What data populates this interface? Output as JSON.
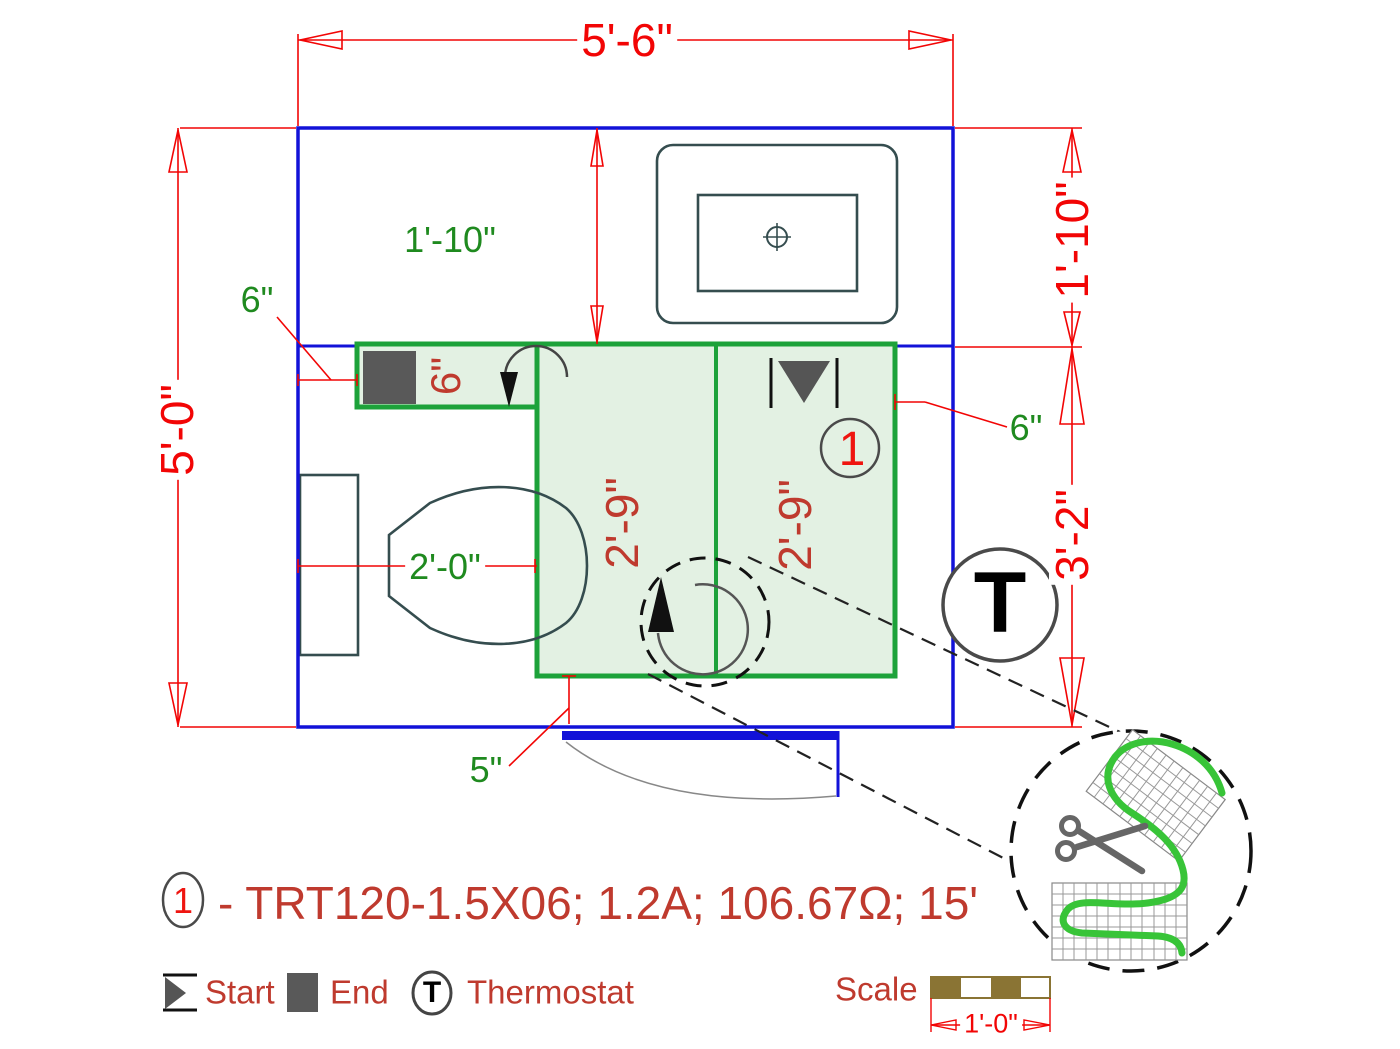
{
  "colors": {
    "wall_blue": "#1212d8",
    "dimension_red": "#f20505",
    "label_red": "#bf3a2e",
    "label_green": "#1f8a1f",
    "mat_border_green": "#1da23a",
    "mat_fill_green": "#e3f1e3",
    "fixture_slate": "#354d4f",
    "symbol_gray": "#555555",
    "wire_green": "#38c438",
    "scale_brown": "#8a7434"
  },
  "dimensions": {
    "room_width_top": "5'-6\"",
    "room_height_left": "5'-0\"",
    "nook_depth_right": "1'-10\"",
    "mat_zone_height_right": "3'-2\"",
    "nook_depth_inner": "1'-10\"",
    "wall_gap_left": "6\"",
    "wall_gap_right": "6\"",
    "strip_width": "6\"",
    "toilet_clearance": "2'-0\"",
    "mat_column_left": "2'-9\"",
    "mat_column_right": "2'-9\"",
    "bottom_gap": "5\""
  },
  "plan": {
    "circuit_marker": "1",
    "thermostat_symbol": "T"
  },
  "legend": {
    "circuit_marker": "1",
    "circuit_spec": "- TRT120-1.5X06; 1.2A; 106.67Ω; 15'",
    "start_label": "Start",
    "end_label": "End",
    "thermostat_symbol": "T",
    "thermostat_label": "Thermostat",
    "scale_label": "Scale",
    "scale_bar_length": "1'-0\""
  }
}
